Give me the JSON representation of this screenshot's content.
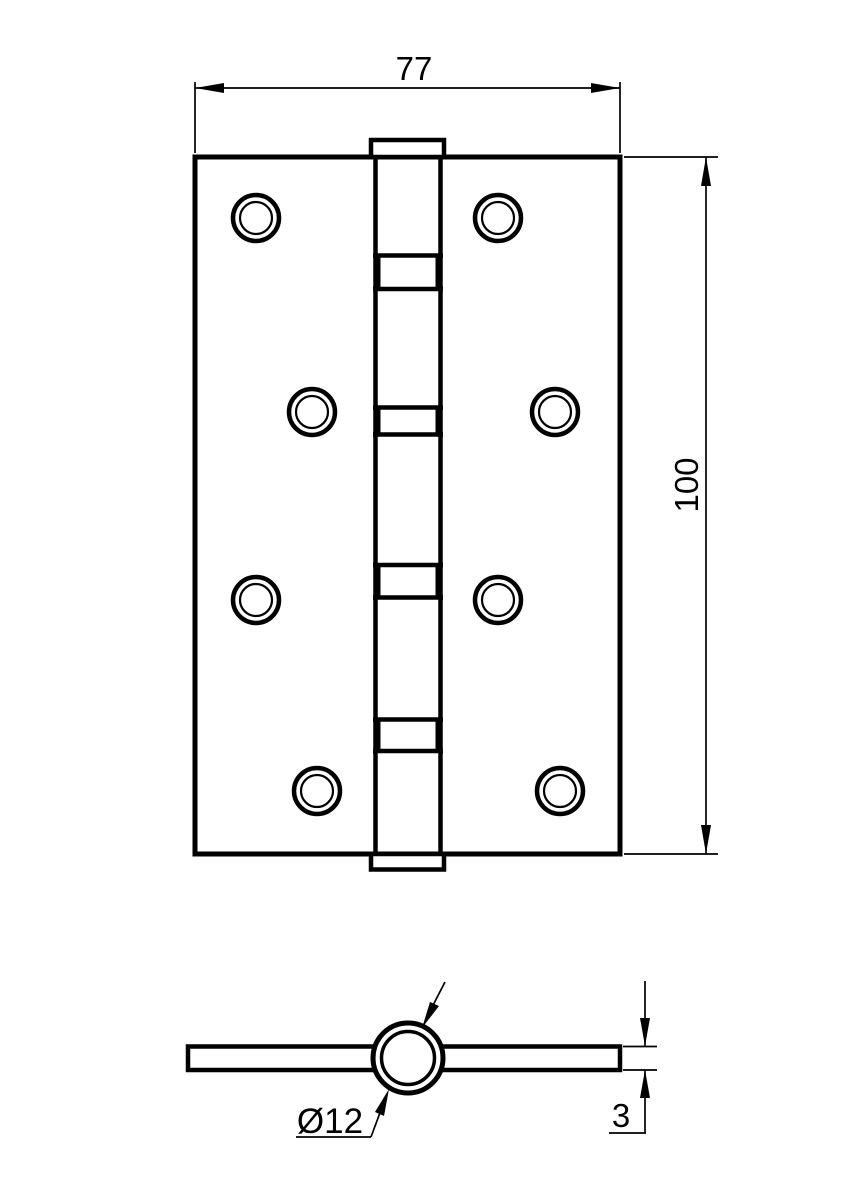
{
  "drawing": {
    "labels": {
      "width": "77",
      "height": "100",
      "pin_diameter": "Ø12",
      "thickness": "3"
    },
    "colors": {
      "line": "#000000",
      "background": "#ffffff"
    }
  }
}
